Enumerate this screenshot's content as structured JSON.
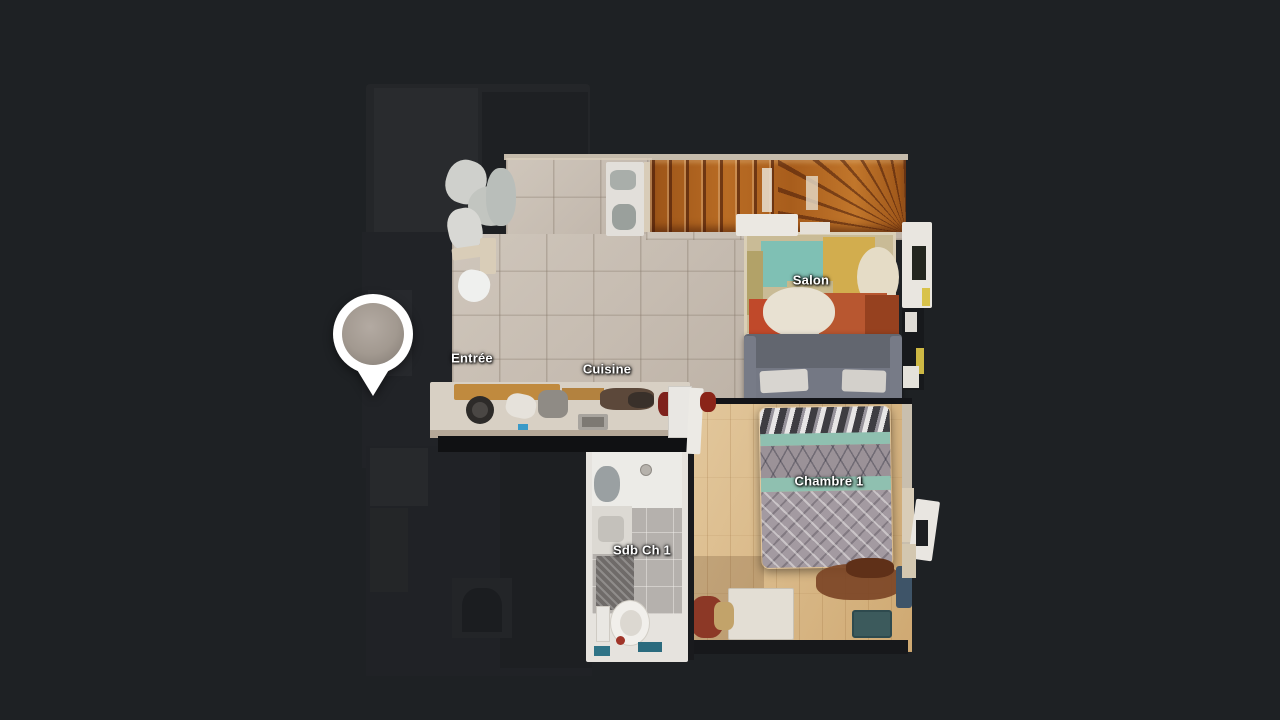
{
  "rooms": {
    "entree": {
      "label": "Entrée"
    },
    "cuisine": {
      "label": "Cuisine"
    },
    "salon": {
      "label": "Salon"
    },
    "chambre1": {
      "label": "Chambre 1"
    },
    "sdb_ch1": {
      "label": "Sdb Ch 1"
    }
  },
  "pin": {
    "description": "current-position-pin"
  },
  "palette": {
    "background": "#1e2124",
    "label_text": "#ffffff",
    "pin_white": "#ffffff",
    "pin_inner_top": "#b3aaa2",
    "pin_inner_bottom": "#8d857d",
    "tile_floor": "#c9bfb5",
    "wood_floor": "#dcbd90",
    "stair_wood": "#ab5c1d",
    "rug_teal": "#7fc0b4",
    "rug_mustard": "#d2ad4e",
    "rug_rust": "#b85730",
    "sofa_gray": "#686c78",
    "duvet_mauve": "#a39aa1",
    "duvet_teal": "#8fc0b0",
    "bath_tile": "#b5b1ad",
    "dark_room": "#242629"
  }
}
